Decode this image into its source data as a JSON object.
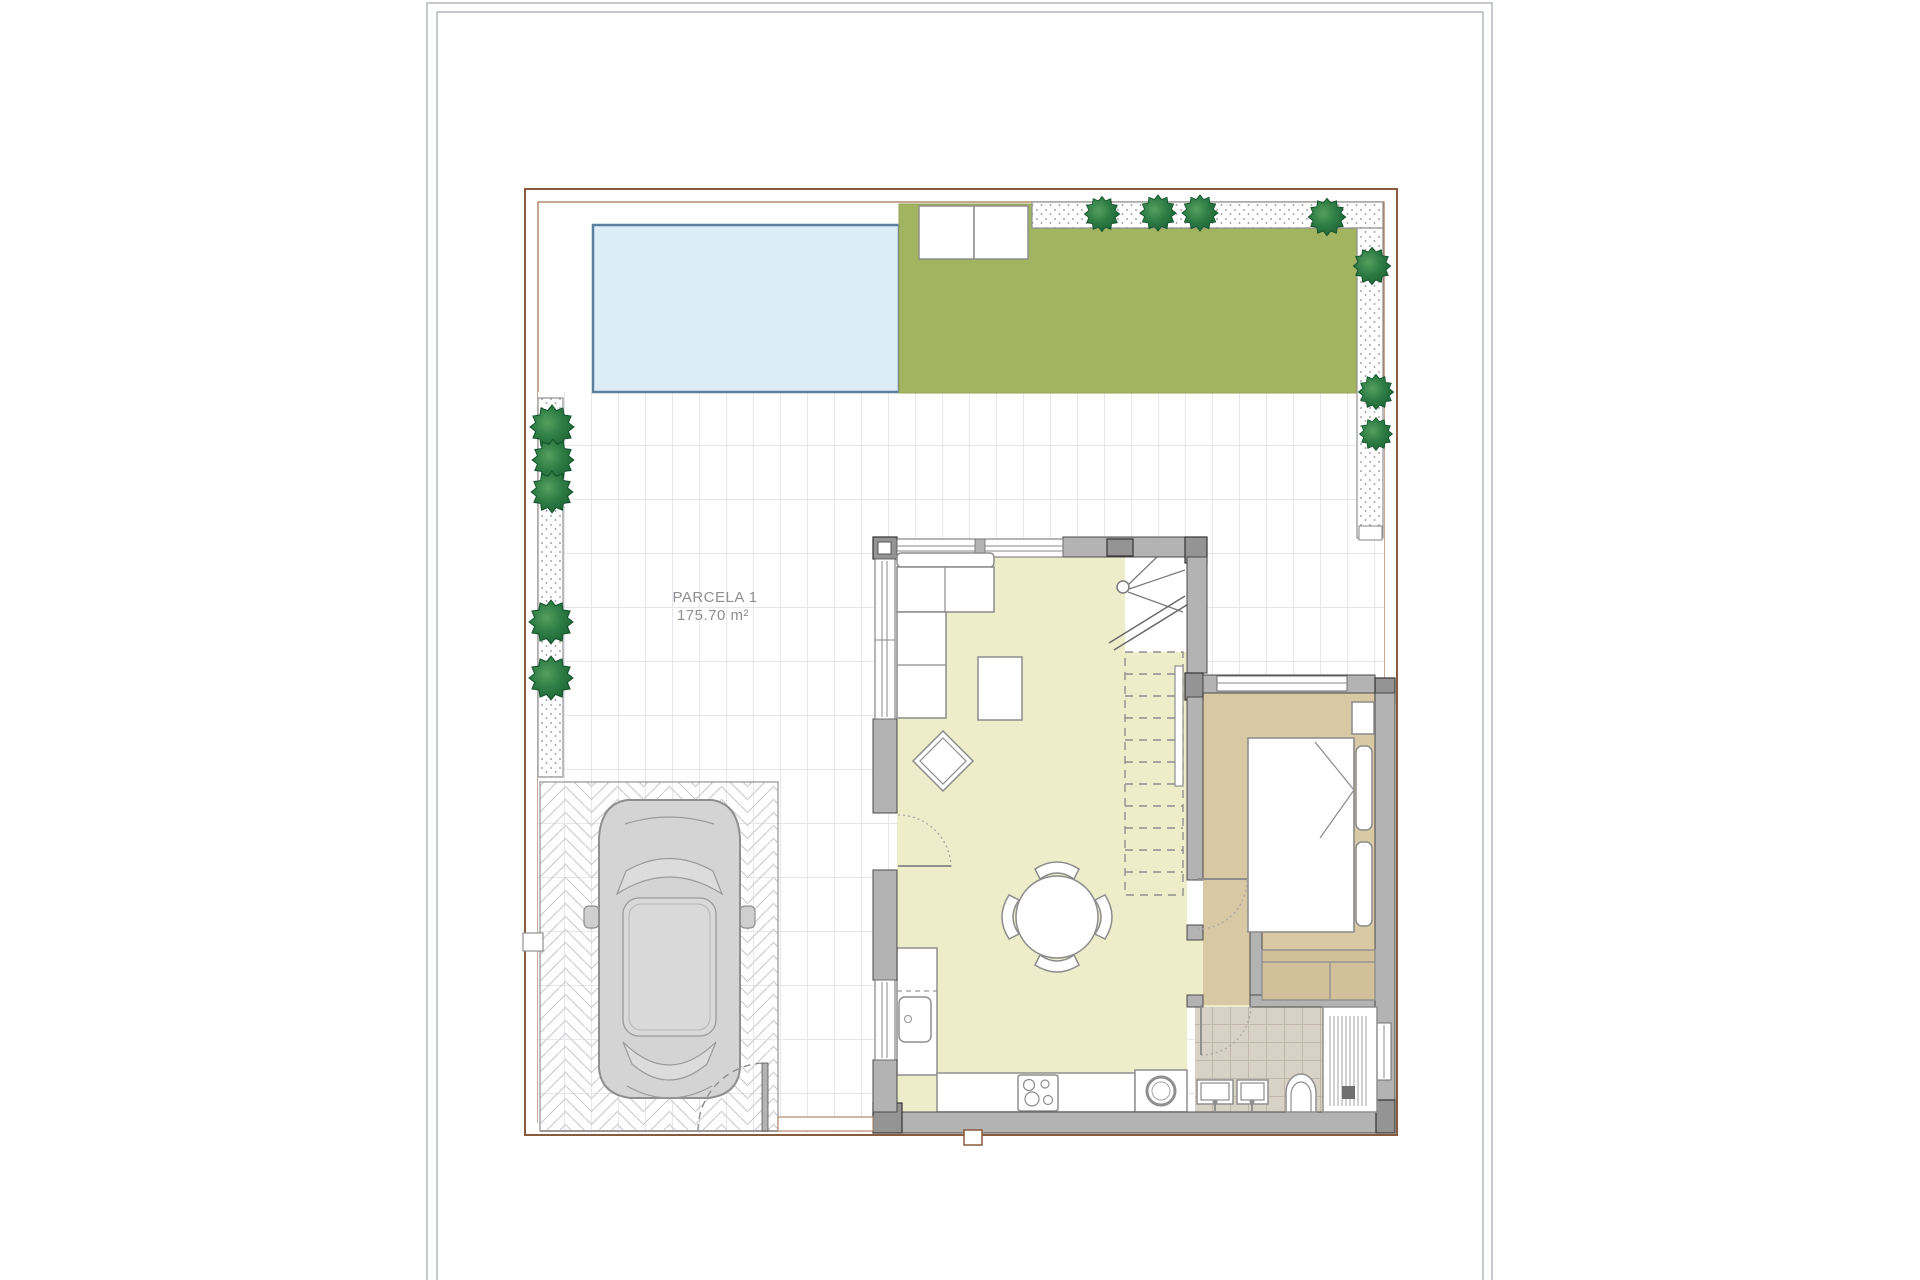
{
  "plan": {
    "parcel_label": "PARCELA 1",
    "parcel_area": "175.70 m²"
  },
  "colors": {
    "boundary_brown": "#8a5a3c",
    "boundary_brown_light": "#a87a5a",
    "pool_fill": "#dcedf8",
    "pool_border": "#5b7f9d",
    "garden_green": "#a2b45f",
    "living_floor": "#ededca",
    "bedroom_floor": "#d9c8a4",
    "wardrobe_fill": "#d2c09a",
    "bathroom_floor": "#d8d1c5",
    "wall_gray": "#b3b3b3",
    "car_gray": "#d4d4d4"
  }
}
